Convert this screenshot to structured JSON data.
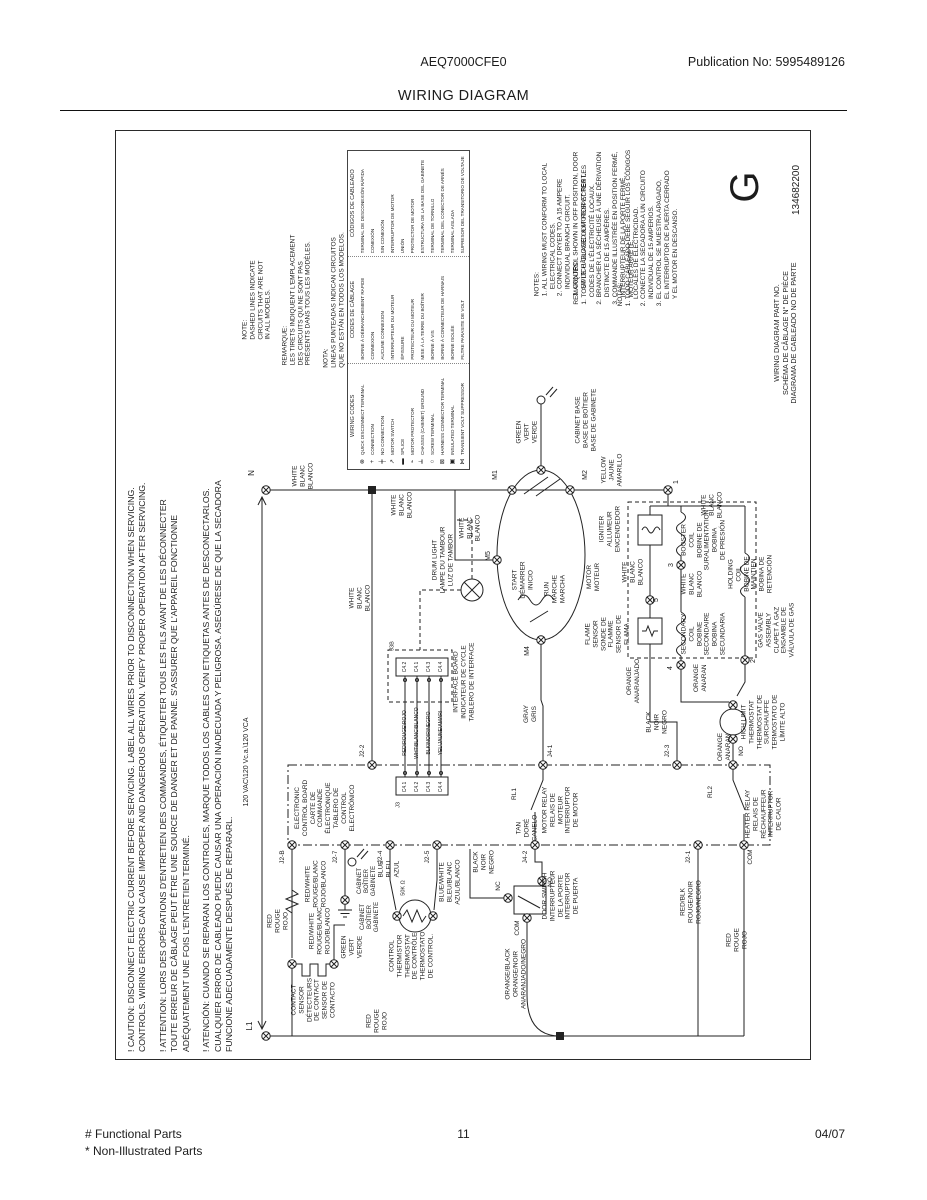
{
  "header": {
    "model": "AEQ7000CFE0",
    "publication": "Publication No:  5995489126",
    "title": "WIRING DIAGRAM"
  },
  "footer": {
    "functional": "# Functional Parts",
    "non_illustrated": "* Non-Illustrated Parts",
    "page_number": "11",
    "date": "04/07"
  },
  "diagram": {
    "part_letter": "G",
    "part_number": "134682200",
    "cautions": [
      "! CAUTION:  DISCONNECT ELECTRIC CURRENT BEFORE SERVICING. LABEL ALL WIRES PRIOR TO DISCONNECTION WHEN SERVICING.\nCONTROLS. WIRING ERRORS CAN CAUSE IMPROPER AND DANGEROUS OPERATION. VERIFY PROPER OPERATION AFTER SERVICING.",
      "! ATTENTION:  LORS DES OPÉRATIONS D'ENTRETIEN DES COMMANDES, ÉTIQUETER TOUS LES FILS AVANT DE LES DÉCONNECTER\nTOUTE ERREUR DE CÂBLAGE PEUT ÊTRE UNE SOURCE DE DANGER ET DE PANNE. S'ASSURER QUE L'APPAREIL FONCTIONNE\nADÉQUATEMENT UNE FOIS L'ENTRETIEN TERMINÉ.",
      "! ATENCIÓN:  CUANDO SE REPARAN LOS CONTROLES, MARQUE TODOS LOS CABLES CON ETIQUETAS ANTES DE DESCONECTARLOS.\nCUALQUIER ERROR DE CABLEADO PUEDE CAUSAR UNA OPERACIÓN INADECUADA Y PELIGROSA. ASEGÚRESE DE QUE LA SECADORA\nFUNCIONE ADECUADAMENTE DESPUÉS DE REPARARL."
    ],
    "legend": {
      "symbols": [
        "⊗",
        "+",
        "╪",
        "↗",
        "▬",
        "⌁",
        "╧",
        "○",
        "⊠",
        "▣",
        "⋈"
      ],
      "columns": [
        {
          "header": "WIRING CODES",
          "items": [
            "QUICK DISCONNECT TERMINAL",
            "CONNECTION",
            "NO CONNECTION",
            "MOTOR SWITCH",
            "SPLICE",
            "MOTOR PROTECTOR",
            "CHASSIS (CABINET) GROUND",
            "SCREW TERMINAL",
            "HARNESS CONNECTOR TERMINAL",
            "INSULATED TERMINAL",
            "TRANSIENT VOLT SUPPRESSOR"
          ]
        },
        {
          "header": "CODES DE CÂBLAGE",
          "items": [
            "BORNE À DÉBRANCHEMENT RAPIDE",
            "CONNEXION",
            "AUCUNE CONNEXION",
            "INTERRUPTEUR DU MOTEUR",
            "ÉPISSURE",
            "PROTECTEUR DU MOTEUR",
            "MISE À LA TERRE DU BOÎTIER",
            "BORNE À VIS",
            "BORNE À CONNECTEUR DE HARNAIS",
            "BORNE ISOLÉE",
            "FILTRE PARASITE DE VOLT"
          ]
        },
        {
          "header": "CÓDIGOS DE CABLEADO",
          "items": [
            "TERMINAL DE DESCONEXIÓN RÁPIDA",
            "CONEXIÓN",
            "SIN CONEXIÓN",
            "INTERRUPTOR DE MOTOR",
            "UNIÓN",
            "PROTECTOR DE MOTOR",
            "ESTRUCTURA DE LA BASE DEL GABINETE",
            "TERMINAL DE TORNILLO",
            "TERMINAL DEL CONECTOR DE ARNÉS",
            "TERMINAL AISLADA",
            "SUPRESOR DEL TRANSITORIO DE VOLTAJE"
          ]
        }
      ]
    },
    "labels": [
      {
        "n": "note-dashed-en",
        "t": "NOTE:\nDASHED LINES INDICATE\nCIRCUITS THAT ARE NOT\nIN ALL MODELS.",
        "x": 257,
        "y": 300,
        "a": "l"
      },
      {
        "n": "note-dashed-fr",
        "t": "REMARQUE:\nLES TIRETS INDIQUENT L'EMPLACEMENT\nDES CIRCUITS QUI NE SONT PAS\nPRÉSENTS DANS TOUS LES MODÈLES.",
        "x": 297,
        "y": 300,
        "a": "l"
      },
      {
        "n": "note-dashed-es",
        "t": "NOTA:\nLINEAS PUNTEADAS INDICAN CIRCUITOS\nQUE NO ESTÁN EN TODOS LOS MODELOS.",
        "x": 334,
        "y": 300,
        "a": "l"
      },
      {
        "n": "notes-en",
        "t": "NOTES:\n1. ALL WIRING MUST CONFORM TO LOCAL\n    ELECTRICAL CODES.\n2. CONNECT DRYER TO A 15 AMPERE\n    INDIVIDUAL BRANCH CIRCUIT.\n3. CONTROL SHOWN IN OFF POSITION, DOOR\n    SWITCH CLOSED & MOTOR AT REST.",
        "x": 561,
        "y": 224,
        "a": "l"
      },
      {
        "n": "notes-fr",
        "t": "REMARQUES:\n1. TOUT LE CÂBLAGE DOIT RESPECTER LES\n    CODES DE L'ÉLECTRICITÉ LOCAUX.\n2. BRANCHER LA SÉCHEUSE À UNE DÉRIVATION\n    DISTINCTE DE 15 AMPÈRES.\n3. COMMANDE ILLUSTRÉE EN POSITION FERMÉ,\n    INTERRUPTEUR DE LA PORTE FERMÉ,\n    MOTEUR ARRÊTÉ.",
        "x": 604,
        "y": 228,
        "a": "l"
      },
      {
        "n": "notes-es",
        "t": "NOTAS:\n1. TODO CABLEADO DEBE SEGUIR LOS CÓDIGOS\n    LOCALES DE ELECTRICIDAD.\n2. CONECTE LA SECADORA A UN CIRCUITO\n    INDIVIDUAL DE 15 AMPERIOS.\n3. EL CONTROL SE MUESTRA APAGADO,\n    EL INTERRUPTOR DE PUERTA CERRADO\n    Y EL MOTOR EN DESCANSO.",
        "x": 648,
        "y": 228,
        "a": "l"
      },
      {
        "n": "part-no-label",
        "t": "WIRING DIAGRAM PART NO.\nSCHÉMA DE CÂBLAGE N° DE PIÈCE\nDIAGRAMA DE CABLEADO NO DE PARTE",
        "x": 786,
        "y": 333,
        "s": 7.2
      },
      {
        "n": "part-no-value",
        "t": "134682200",
        "x": 797,
        "y": 190,
        "s": 10
      },
      {
        "n": "revision-letter",
        "t": "G",
        "x": 745,
        "y": 187,
        "s": 40
      },
      {
        "n": "voltage-label",
        "t": "120 VAC\\120 Vc.a.\\120 VCA",
        "x": 247,
        "y": 762,
        "s": 7
      },
      {
        "n": "terminal-n",
        "t": "N",
        "x": 252,
        "y": 473,
        "s": 8
      },
      {
        "n": "terminal-l1",
        "t": "L1",
        "x": 250,
        "y": 1026,
        "s": 8
      },
      {
        "n": "wire-white-1",
        "t": "WHITE\nBLANC\nBLANCO",
        "x": 303,
        "y": 476
      },
      {
        "n": "wire-white-2",
        "t": "WHITE\nBLANC\nBLANCO",
        "x": 402,
        "y": 505
      },
      {
        "n": "wire-white-3",
        "t": "WHITE\nBLANC\nBLANCO",
        "x": 360,
        "y": 598
      },
      {
        "n": "wire-white-4",
        "t": "WHITE\nBLANC\nBLANCO",
        "x": 470,
        "y": 528
      },
      {
        "n": "wire-white-5",
        "t": "WHITE\nBLANC\nBLANCO",
        "x": 712,
        "y": 505
      },
      {
        "n": "wire-white-6",
        "t": "WHITE\nBLANC\nBLANCO",
        "x": 633,
        "y": 572
      },
      {
        "n": "wire-white-7",
        "t": "WHITE\nBLANC\nBLANCO",
        "x": 692,
        "y": 584
      },
      {
        "n": "wire-green-1",
        "t": "GREEN\nVERT\nVERDE",
        "x": 527,
        "y": 432
      },
      {
        "n": "wire-green-2",
        "t": "GREEN\nVERT\nVERDE",
        "x": 352,
        "y": 947
      },
      {
        "n": "wire-yellow",
        "t": "YELLOW\nJAUNE\nAMARILLO",
        "x": 612,
        "y": 470
      },
      {
        "n": "cabinet-base",
        "t": "CABINET BASE\nBASE DE BOÎTIER\nBASE DE GABINETE",
        "x": 586,
        "y": 420
      },
      {
        "n": "drum-light",
        "t": "DRUM LIGHT\nLAMPE DU TAMBOUR\nLUZ DE TAMBOR",
        "x": 443,
        "y": 560
      },
      {
        "n": "terminal-m1",
        "t": "M1",
        "x": 496,
        "y": 475,
        "s": 7
      },
      {
        "n": "terminal-m2",
        "t": "M2",
        "x": 586,
        "y": 475,
        "s": 7
      },
      {
        "n": "terminal-m5",
        "t": "M5",
        "x": 489,
        "y": 556,
        "s": 7
      },
      {
        "n": "terminal-m4",
        "t": "M4",
        "x": 528,
        "y": 651,
        "s": 7
      },
      {
        "n": "motor-start",
        "t": "START\nDÉMARRER\nINICIO",
        "x": 523,
        "y": 580
      },
      {
        "n": "motor-run",
        "t": "RUN\nMARCHE\nMARCHA",
        "x": 555,
        "y": 589
      },
      {
        "n": "motor",
        "t": "MOTOR\nMOTEUR",
        "x": 594,
        "y": 577
      },
      {
        "n": "igniter",
        "t": "IGNITER\nALLUMEUR\nENCENDEDOR",
        "x": 610,
        "y": 529
      },
      {
        "n": "flame-sensor",
        "t": "FLAME\nSENSOR\nSONDE DE\nFLAMME\nSENSOR DE\nFLAMA",
        "x": 608,
        "y": 634
      },
      {
        "n": "booster-coil",
        "t": "BOOSTER\nCOIL\nBOBINE DE\nSURALIMENTATION\nBOBINA\nDE PRESIÓN",
        "x": 704,
        "y": 540
      },
      {
        "n": "holding-coil",
        "t": "HOLDING\nCOIL\nBOBINE DE\nMAINTIEN\nBOBINA DE\nRETENCIÓN",
        "x": 751,
        "y": 574
      },
      {
        "n": "secondary-coil",
        "t": "SECONDARY\nCOIL\nBOBINE\nSECONDAIRE\nBOBINA\nSECUNDARIA",
        "x": 704,
        "y": 634
      },
      {
        "n": "gas-valve",
        "t": "GAS VALVE\nASSEMBLY\nCLAPET À GAZ\nENSAMBLE DE\nVÁLVULA DE GAS",
        "x": 777,
        "y": 630
      },
      {
        "n": "high-limit-thermostat",
        "t": "HIGH LIMIT\nTHERMOSTAT\nTHERMOSTAT DE\nSURCHAUFFE\nTERMOSTATO DE\nLÍMITE ALTO",
        "x": 764,
        "y": 722
      },
      {
        "n": "heater-relay",
        "t": "HEATER RELAY\nRELAIS DE\nRÉCHAUFFEUR\nINTERRUPTOR\nDE CALOR",
        "x": 764,
        "y": 814
      },
      {
        "n": "motor-relay",
        "t": "MOTOR RELAY\nRELAIS DE\nMOTEUR\nINTERRUPTOR\nDE MOTOR",
        "x": 561,
        "y": 810
      },
      {
        "n": "door-switch",
        "t": "DOOR SWITCH\nINTERRUPTEUR\nDE LA PORTE\nINTERRUPTOR\nDE PUERTA",
        "x": 561,
        "y": 896
      },
      {
        "n": "interface-board",
        "t": "INTERFACE BOARD\nINDICATEUR DE CYCLE\nTABLERO DE INTERFACE",
        "x": 464,
        "y": 682
      },
      {
        "n": "electronic-control-board",
        "t": "ELECTRONIC\nCONTROL BOARD\nCARTE DE\nCOMMANDE\nÉLECTRONIQUE\nTABLERO DE\nCONTROL\nELECTRÓNICO",
        "x": 325,
        "y": 808
      },
      {
        "n": "contact-sensor",
        "t": "CONTACT\nSENSOR\nDÉTECTEURS\nDE CONTACT\nSENSOR DE\nCONTACTO",
        "x": 314,
        "y": 1000
      },
      {
        "n": "control-thermistor",
        "t": "CONTROL\nTHERMISTOR\nTHERMOSTAT\nDE CONTRÔLE\nTHERMOSTATO\nDE CONTROL.",
        "x": 412,
        "y": 956
      },
      {
        "n": "wire-gray",
        "t": "GRAY\nGRIS",
        "x": 531,
        "y": 714
      },
      {
        "n": "wire-tan",
        "t": "TAN\nDORÉ\nCANELO",
        "x": 527,
        "y": 828
      },
      {
        "n": "wire-black-1",
        "t": "BLACK\nNOIR\nNEGRO",
        "x": 484,
        "y": 862
      },
      {
        "n": "wire-black-2",
        "t": "BLACK\nNOIR\nNEGRO",
        "x": 657,
        "y": 722
      },
      {
        "n": "wire-orange-1",
        "t": "ORANGE\nANARANJADO",
        "x": 634,
        "y": 681
      },
      {
        "n": "wire-orange-2",
        "t": "ORANGE\nANARAN",
        "x": 701,
        "y": 678
      },
      {
        "n": "wire-orange-3",
        "t": "ORANGE\nANARAN",
        "x": 725,
        "y": 747
      },
      {
        "n": "wire-red-white-1",
        "t": "RED/WHITE\nROUGE/BLANC\nROJO/BLANCO",
        "x": 316,
        "y": 884
      },
      {
        "n": "wire-red-white-2",
        "t": "RED/WHITE\nROUGE/BLANC\nROJO/BLANCO",
        "x": 320,
        "y": 931
      },
      {
        "n": "wire-red-1",
        "t": "RED\nROUGE\nROJO",
        "x": 278,
        "y": 921
      },
      {
        "n": "wire-red-2",
        "t": "RED\nROUGE\nROJO",
        "x": 377,
        "y": 1021
      },
      {
        "n": "wire-red-3",
        "t": "RED\nROUGE\nROJO",
        "x": 737,
        "y": 940
      },
      {
        "n": "wire-red-blk",
        "t": "RED/BLK\nROUGE/NOIR\nROJO/NEGRO",
        "x": 691,
        "y": 902
      },
      {
        "n": "wire-orange-black",
        "t": "ORANGE/BLACK\nORANGE/NOIR\nANARANJADO/NEGRO",
        "x": 516,
        "y": 974
      },
      {
        "n": "wire-blue",
        "t": "BLUE\nBLEU\nAZUL",
        "x": 389,
        "y": 869
      },
      {
        "n": "wire-blue-white",
        "t": "BLUE/WHITE\nBLEU/BLANC\nAZUL/BLANCO",
        "x": 450,
        "y": 882
      },
      {
        "n": "thermistor-value",
        "t": "50K Ω",
        "x": 404,
        "y": 888,
        "s": 5.5
      },
      {
        "n": "cabinet-ground-1",
        "t": "CABINET\nBOÎTIER\nGABINETE",
        "x": 368,
        "y": 881,
        "s": 6
      },
      {
        "n": "cabinet-ground-2",
        "t": "CABINET\nBOÎTIER\nGABINETE",
        "x": 371,
        "y": 917,
        "s": 6
      },
      {
        "n": "connector-j2b",
        "t": "J2-B",
        "x": 283,
        "y": 857
      },
      {
        "n": "connector-j27",
        "t": "J2-7",
        "x": 336,
        "y": 857
      },
      {
        "n": "connector-j24",
        "t": "J2-4",
        "x": 381,
        "y": 857
      },
      {
        "n": "connector-j25",
        "t": "J2-5",
        "x": 428,
        "y": 857
      },
      {
        "n": "connector-j42",
        "t": "J4-2",
        "x": 526,
        "y": 857
      },
      {
        "n": "connector-j21",
        "t": "J2-1",
        "x": 689,
        "y": 857
      },
      {
        "n": "terminal-com-heater",
        "t": "COM",
        "x": 751,
        "y": 857
      },
      {
        "n": "connector-j22",
        "t": "J2-2",
        "x": 363,
        "y": 751
      },
      {
        "n": "connector-j41",
        "t": "J4-1",
        "x": 551,
        "y": 751
      },
      {
        "n": "connector-j23",
        "t": "J2-3",
        "x": 668,
        "y": 751
      },
      {
        "n": "terminal-no-heater",
        "t": "NO",
        "x": 742,
        "y": 751
      },
      {
        "n": "terminal-com-door",
        "t": "COM",
        "x": 518,
        "y": 928
      },
      {
        "n": "terminal-no-door",
        "t": "NO",
        "x": 551,
        "y": 882
      },
      {
        "n": "terminal-nc-door",
        "t": "NC",
        "x": 499,
        "y": 886
      },
      {
        "n": "relay-rl1",
        "t": "RL1",
        "x": 515,
        "y": 794
      },
      {
        "n": "relay-rl2",
        "t": "RL2",
        "x": 711,
        "y": 792
      },
      {
        "n": "connector-j3b",
        "t": "J3B",
        "x": 393,
        "y": 646,
        "s": 5.5
      },
      {
        "n": "connector-j3",
        "t": "J3",
        "x": 399,
        "y": 805,
        "s": 5.5
      },
      {
        "n": "pin-c42-top",
        "t": "C4.2",
        "x": 405,
        "y": 667,
        "s": 5
      },
      {
        "n": "pin-c41-top",
        "t": "C4.1",
        "x": 417,
        "y": 667,
        "s": 5
      },
      {
        "n": "pin-c43-top",
        "t": "C4.3",
        "x": 429,
        "y": 667,
        "s": 5
      },
      {
        "n": "pin-c44-top",
        "t": "C4.4",
        "x": 441,
        "y": 667,
        "s": 5
      },
      {
        "n": "wire-red-code",
        "t": "RED\\ROUGE\\ROJO",
        "x": 405,
        "y": 733,
        "s": 5
      },
      {
        "n": "wire-wht-code",
        "t": "WHT\\BLANC\\BLANCO",
        "x": 417,
        "y": 733,
        "s": 5
      },
      {
        "n": "wire-blk-code",
        "t": "BLK\\NOIR\\NEGRO",
        "x": 429,
        "y": 733,
        "s": 5
      },
      {
        "n": "wire-yel-code",
        "t": "YEL\\JAUNE\\AMARI",
        "x": 441,
        "y": 733,
        "s": 5
      },
      {
        "n": "pin-c41-bot",
        "t": "C4.1",
        "x": 405,
        "y": 787,
        "s": 5
      },
      {
        "n": "pin-c42-bot",
        "t": "C4.2",
        "x": 417,
        "y": 787,
        "s": 5
      },
      {
        "n": "pin-c43-bot",
        "t": "C4.3",
        "x": 429,
        "y": 787,
        "s": 5
      },
      {
        "n": "pin-c44-bot",
        "t": "C4.4",
        "x": 441,
        "y": 787,
        "s": 5
      },
      {
        "n": "gas-terminal-1",
        "t": "1",
        "x": 677,
        "y": 482,
        "s": 7
      },
      {
        "n": "gas-terminal-3",
        "t": "3",
        "x": 672,
        "y": 565,
        "s": 7
      },
      {
        "n": "gas-terminal-5",
        "t": "5",
        "x": 657,
        "y": 600,
        "s": 7
      },
      {
        "n": "gas-terminal-4",
        "t": "4",
        "x": 671,
        "y": 668,
        "s": 7
      },
      {
        "n": "gas-terminal-2",
        "t": "2",
        "x": 754,
        "y": 661,
        "s": 7
      }
    ]
  }
}
